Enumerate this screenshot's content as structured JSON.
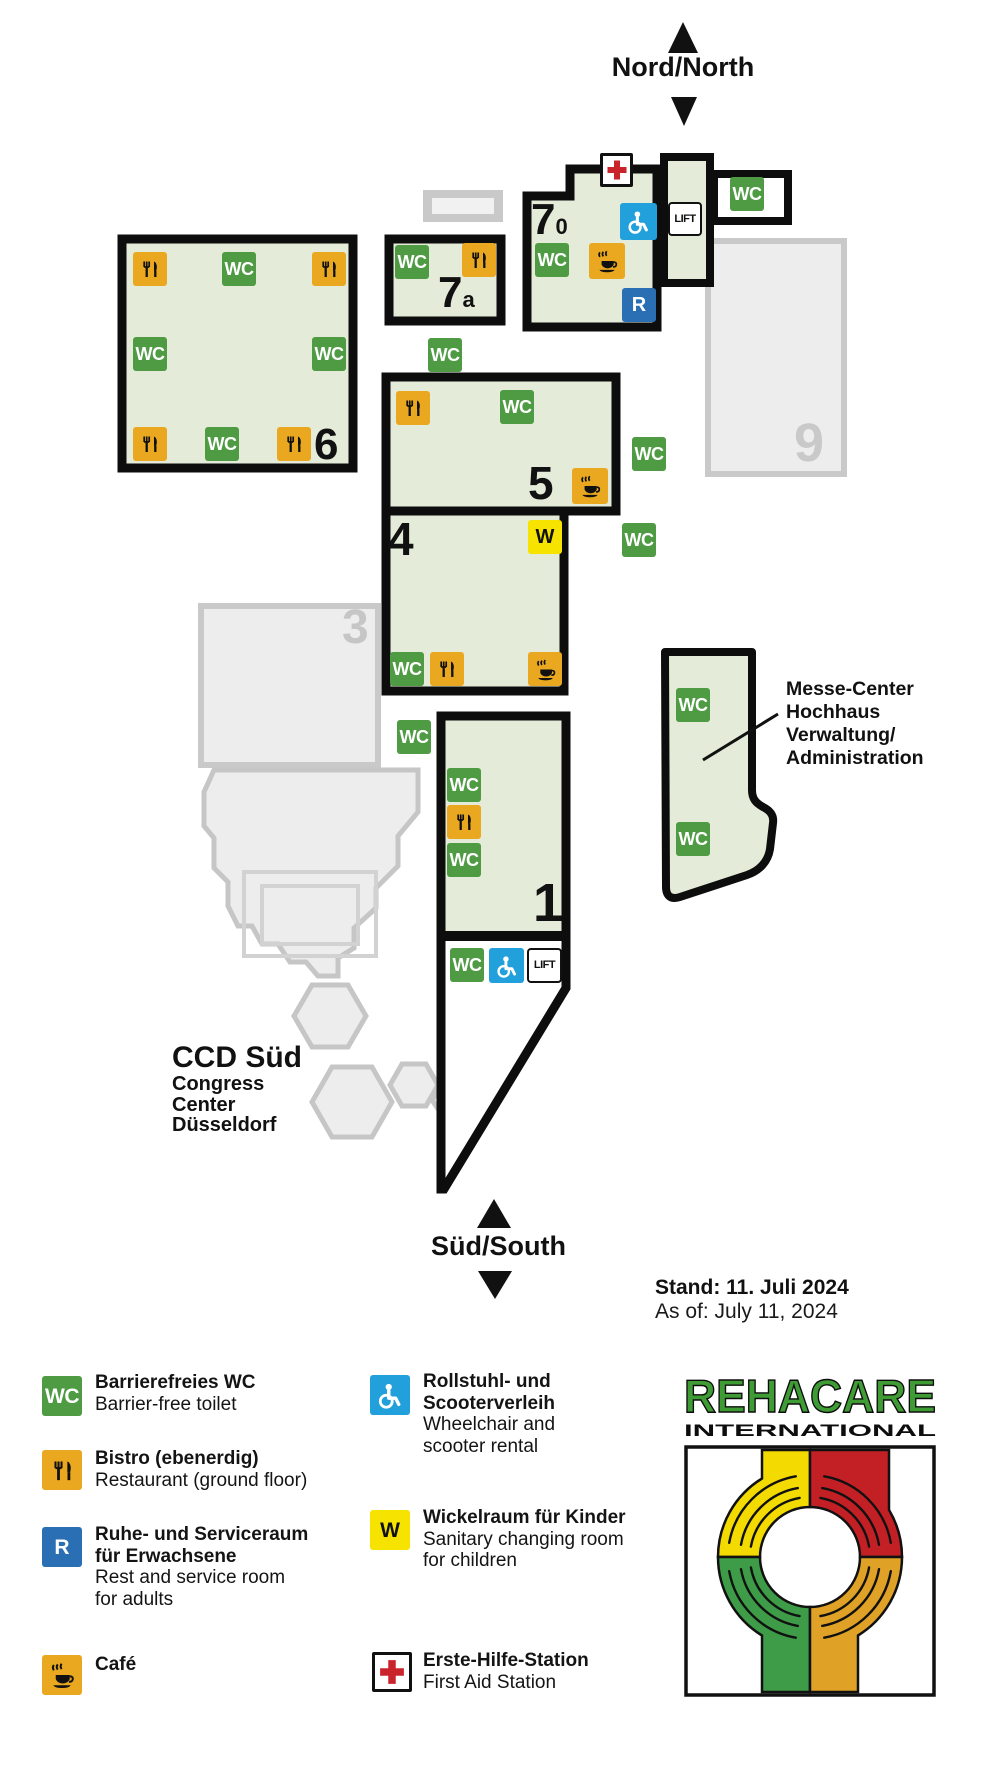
{
  "compass": {
    "north": "Nord/North",
    "south": "Süd/South"
  },
  "badges": {
    "wc": "WC",
    "lift": "LIFT",
    "rest": "R",
    "wickel": "W"
  },
  "halls": {
    "h70": {
      "num": "7",
      "sub": "0"
    },
    "h7a": {
      "num": "7",
      "sub": "a"
    },
    "h6": "6",
    "h5": "5",
    "h4": "4",
    "h1": "1",
    "h3": "3",
    "h9": "9"
  },
  "messe_center": {
    "line1": "Messe-Center",
    "line2": "Hochhaus",
    "line3": "Verwaltung/",
    "line4": "Administration"
  },
  "ccd": {
    "title": "CCD Süd",
    "line1": "Congress",
    "line2": "Center",
    "line3": "Düsseldorf"
  },
  "stand": {
    "de": "Stand: 11. Juli 2024",
    "en": "As of: July 11, 2024"
  },
  "legend": {
    "wc": {
      "de": "Barrierefreies WC",
      "en": "Barrier-free toilet"
    },
    "bistro": {
      "de": "Bistro (ebenerdig)",
      "en": "Restaurant (ground floor)"
    },
    "rest": {
      "de1": "Ruhe- und Serviceraum",
      "de2": "für Erwachsene",
      "en1": "Rest and service room",
      "en2": "for adults"
    },
    "cafe": {
      "de": "Café"
    },
    "wheelchair": {
      "de1": "Rollstuhl- und",
      "de2": "Scooterverleih",
      "en1": "Wheelchair and",
      "en2": "scooter rental"
    },
    "wickelraum": {
      "de": "Wickelraum für Kinder",
      "en1": "Sanitary changing room",
      "en2": "for children"
    },
    "firstaid": {
      "de": "Erste-Hilfe-Station",
      "en": "First Aid Station"
    }
  },
  "logo": {
    "name": "REHACARE",
    "sub": "INTERNATIONAL"
  },
  "colors": {
    "hall_fill": "#e4ecd9",
    "outline": "#0d0d0d",
    "wc_green": "#4f9b44",
    "bistro_orange": "#e9a81f",
    "rest_blue": "#2a6fb4",
    "wheelchair_blue": "#22a0db",
    "wickel_yellow": "#f6e400",
    "aid_red": "#c9232b",
    "inactive_gray": "#ededed",
    "logo_green": "#3f9c35",
    "logo_yellow": "#f3da00",
    "logo_red": "#c32026",
    "logo_hand_green": "#3e9b47",
    "logo_orange": "#dfa126"
  }
}
